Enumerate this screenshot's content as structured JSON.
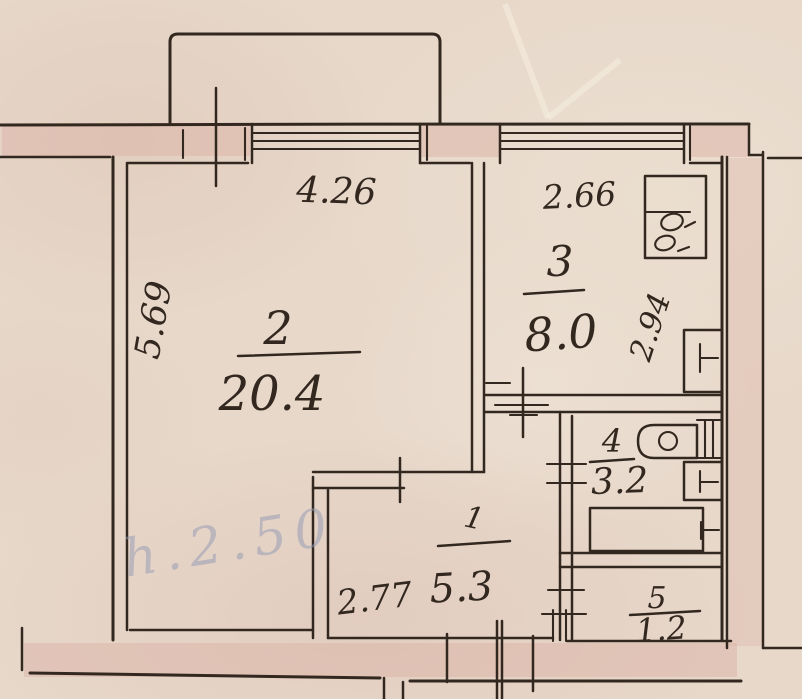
{
  "plan": {
    "rooms": [
      {
        "number": "1",
        "area": "5.3",
        "width": "2.77"
      },
      {
        "number": "2",
        "area": "20.4",
        "width": "4.26",
        "depth": "5.69"
      },
      {
        "number": "3",
        "area": "8.0",
        "width": "2.66",
        "depth": "2.94"
      },
      {
        "number": "4",
        "area": "3.2"
      },
      {
        "number": "5",
        "area": "1.2"
      }
    ],
    "pencil_note": "h.2.50",
    "fixtures": [
      {
        "name": "stove"
      },
      {
        "name": "kitchen-sink"
      },
      {
        "name": "toilet"
      },
      {
        "name": "washbasin"
      },
      {
        "name": "bathtub"
      }
    ],
    "colors": {
      "ink": "#33281f",
      "paper": "#e7d8ca",
      "wall_fill": "#ddb6a9",
      "pencil": "#9298b4"
    }
  }
}
